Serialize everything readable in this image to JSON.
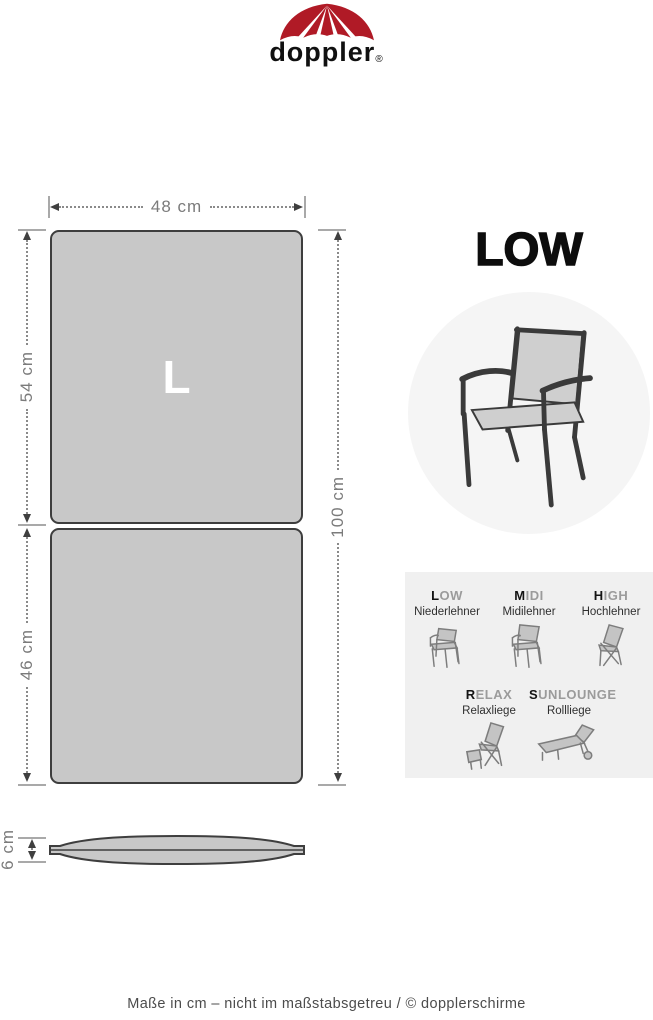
{
  "logo": {
    "text": "doppler",
    "registered": "®"
  },
  "dimensions": {
    "width": "48 cm",
    "upper_height": "54 cm",
    "lower_height": "46 cm",
    "total_height": "100 cm",
    "thickness": "6 cm",
    "size_letter": "L"
  },
  "product": {
    "type_title": "LOW"
  },
  "selector": {
    "items": [
      {
        "first": "L",
        "rest": "OW",
        "subtitle": "Niederlehner",
        "icon": "chair-low-icon"
      },
      {
        "first": "M",
        "rest": "IDI",
        "subtitle": "Midilehner",
        "icon": "chair-midi-icon"
      },
      {
        "first": "H",
        "rest": "IGH",
        "subtitle": "Hochlehner",
        "icon": "chair-high-icon"
      },
      {
        "first": "R",
        "rest": "ELAX",
        "subtitle": "Relaxliege",
        "icon": "chair-relax-icon"
      },
      {
        "first": "S",
        "rest": "UNLOUNGE",
        "subtitle": "Rollliege",
        "icon": "sunlounge-icon"
      }
    ]
  },
  "footer": {
    "text": "Maße in cm – nicht im maßstabsgetreu  / © dopplerschirme"
  },
  "colors": {
    "brand_red": "#b01a26",
    "cushion_gray": "#c8c8c8",
    "cushion_border": "#3e3e3e",
    "circle_gray": "#f5f5f5",
    "panel_gray": "#f0f0f0",
    "dim_gray": "#7b7b7b"
  },
  "icons": {
    "umbrella-logo-icon": "doppler umbrella canopy",
    "chair-hero-icon": "stacking armchair with low backrest",
    "chair-low-icon": "low-back chair",
    "chair-midi-icon": "midi-back chair",
    "chair-high-icon": "high-back folding chair",
    "chair-relax-icon": "recliner with footrest",
    "sunlounge-icon": "rolling sun lounger"
  }
}
